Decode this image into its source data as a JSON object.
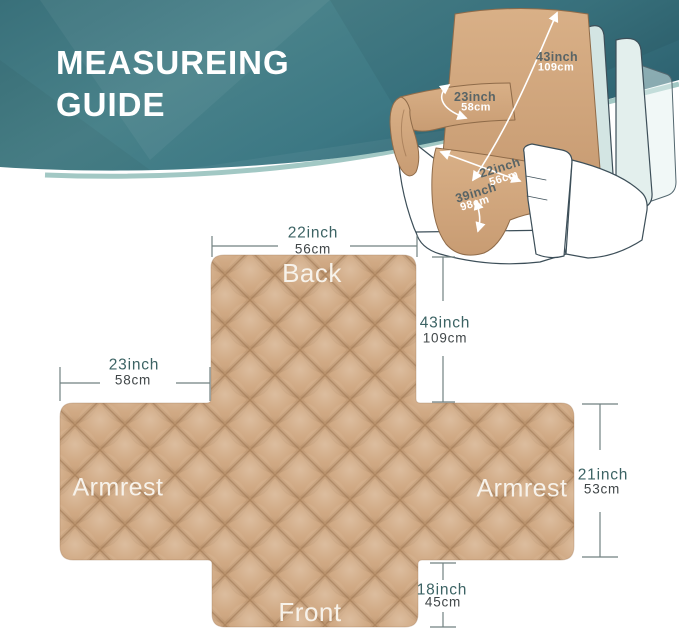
{
  "header": {
    "title_line1": "MEASUREING",
    "title_line2": "GUIDE"
  },
  "chair_annotations": {
    "back_height": {
      "inch": "43inch",
      "cm": "109cm"
    },
    "armrest_width": {
      "inch": "23inch",
      "cm": "58cm"
    },
    "seat_width": {
      "inch": "22inch",
      "cm": "56cm"
    },
    "seat_front": {
      "inch": "39inch",
      "cm": "98cm"
    }
  },
  "flat_diagram": {
    "panels": {
      "back": "Back",
      "armrest_left": "Armrest",
      "armrest_right": "Armrest",
      "front": "Front"
    },
    "dimensions": {
      "back_width": {
        "inch": "22inch",
        "cm": "56cm"
      },
      "back_height": {
        "inch": "43inch",
        "cm": "109cm"
      },
      "armrest_width": {
        "inch": "23inch",
        "cm": "58cm"
      },
      "armrest_height": {
        "inch": "21inch",
        "cm": "53cm"
      },
      "front_height": {
        "inch": "18inch",
        "cm": "45cm"
      }
    }
  },
  "colors": {
    "banner_teal": "#3f7680",
    "banner_edge_mint": "#a2c8c4",
    "fabric_tan": "#cda47d",
    "dim_inch_text": "#3c6364",
    "dim_cm_text": "#414749",
    "dim_line": "#718181",
    "panel_text": "#f7f2ea"
  }
}
